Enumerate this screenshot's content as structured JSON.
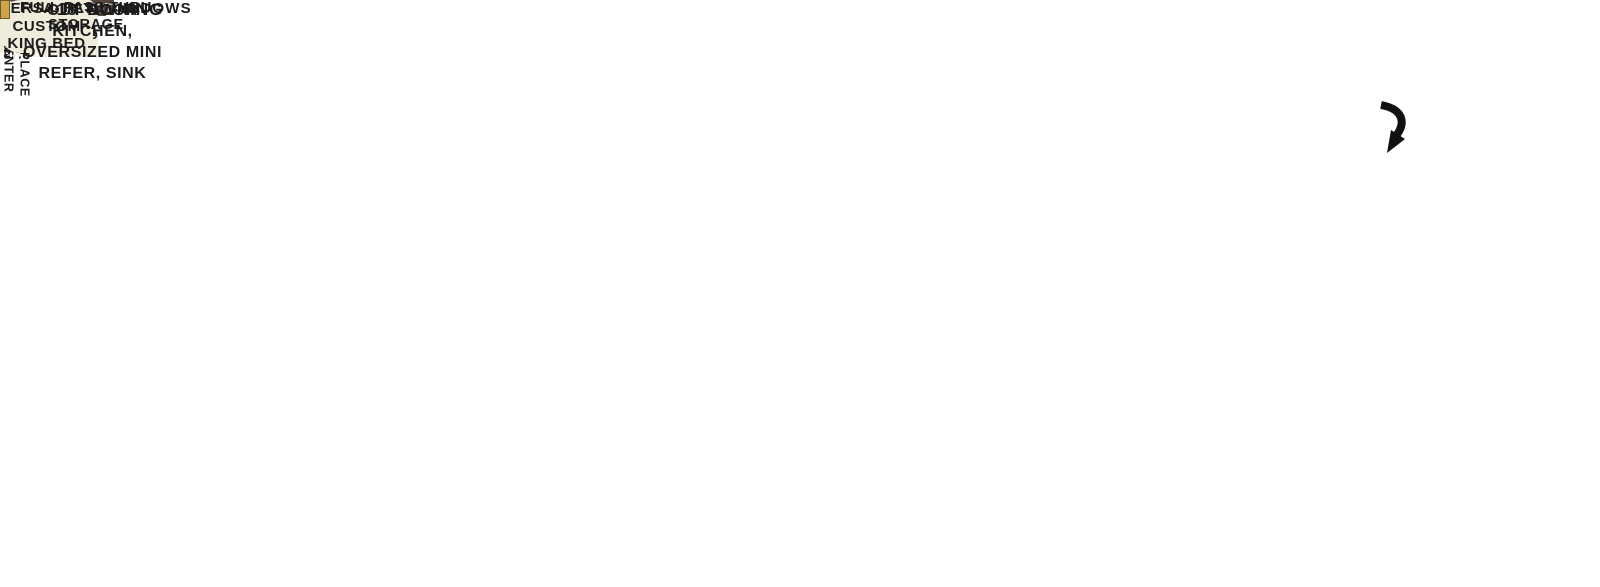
{
  "title": "Travel trailer floorplan",
  "callouts": {
    "panoramic_windows": "PANORAMIC WINDOWS",
    "full_pass_thru_storage": "FULL PASS THRU\nSTORAGE",
    "awning": "18’ AWNING",
    "outdoor_kitchen": "OUT DOOR\nKITCHEN,\nOVERSIZED MINI\nREFER, SINK"
  },
  "bunk_room": {
    "top_bunk": "30 x 74\nBUNK",
    "sofa": "VERSA-QUEEN",
    "closet_top": "CLOSET",
    "ent_center": "ENT. CENTER",
    "closet_bottom": "CLOSET",
    "lower_bunk": "38 x 74\nBUNK\n30 x 74 HINGED\nLOWER BUNK"
  },
  "living_area": {
    "lounge": "VERSA-LOUNGE",
    "ent_center_fireplace": "ENT. CENTER\nW/ FIREPLACE"
  },
  "bathroom": {
    "shower": "WALK-IN\nSHOWER"
  },
  "kitchen": {
    "fridge": "FRIDGE",
    "micro": "MICRO",
    "ohc": "OHC"
  },
  "bedroom": {
    "closet": "CLOSEST",
    "bed": "VERSA-TILT\nCUSTOM\nKING BED",
    "ohc": "OHC"
  },
  "colors": {
    "wall": "#3b3b3e",
    "trim": "#c6c2b9",
    "floor": "#dfdaca",
    "slide_floor": "#a9a49c",
    "cabinet": "#55453c",
    "cabinet_dark": "#42332b",
    "sofa": "#6e5740",
    "sofa_dark": "#5a452f",
    "mattress": "#efecdc",
    "fridge": "#8e8e90",
    "label_dark": "#1b1b1b",
    "label_light": "#ffffff",
    "flame_top": "#f7a823",
    "flame_bottom": "#b35a00",
    "window_black": "#121215",
    "tv_black": "#14171c",
    "marker_light": "#cda44c",
    "bath_wall": "#d9d6cf"
  }
}
